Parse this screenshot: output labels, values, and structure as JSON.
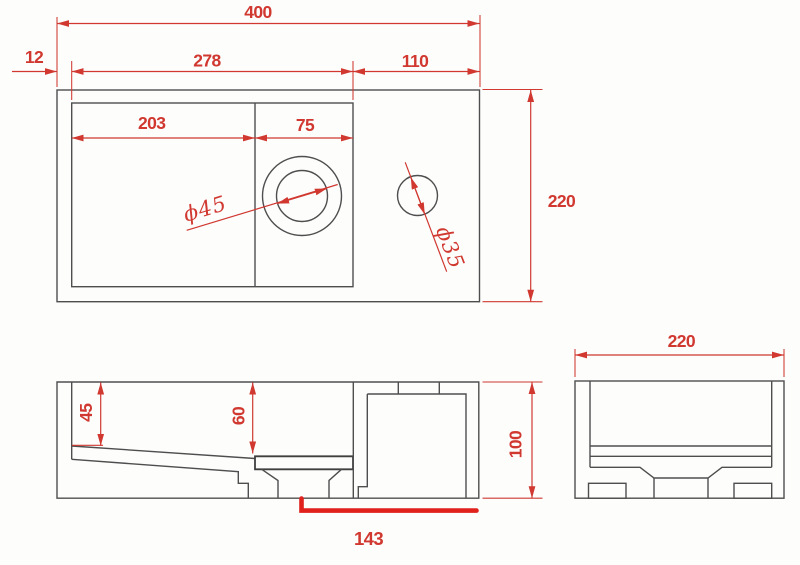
{
  "drawing": {
    "top_view": {
      "total_width": "400",
      "left_rim": "12",
      "inner_width": "278",
      "deck_width": "110",
      "total_depth": "220",
      "basin_section_width": "203",
      "drain_section_width": "75",
      "drain_diameter": "ϕ45",
      "faucet_hole_diameter": "ϕ35"
    },
    "front_view": {
      "basin_depth_left": "45",
      "basin_depth_center": "60",
      "drain_offset": "143"
    },
    "side_view": {
      "depth": "220",
      "height": "100"
    },
    "colors": {
      "dimension_red": "#d03830",
      "highlight_red": "#e0211c",
      "outline_gray": "#4e4e4e",
      "background": "#fdfdfc"
    }
  }
}
